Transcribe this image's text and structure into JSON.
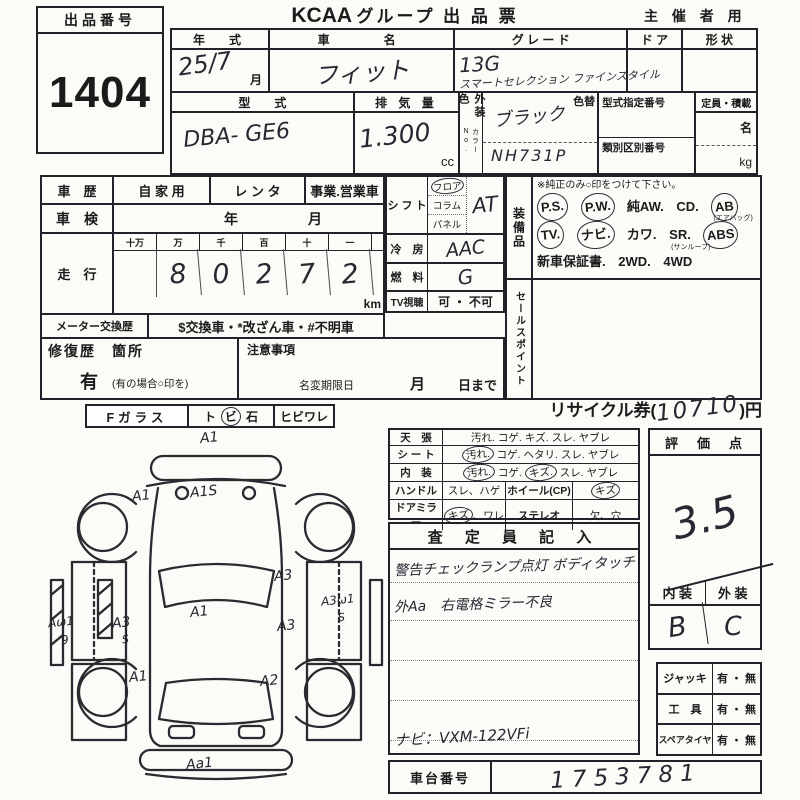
{
  "header": {
    "lot_label": "出品番号",
    "lot_number": "1404",
    "brand": "KCAA",
    "title": "グループ 出 品 票",
    "audience": "主 催 者 用"
  },
  "vehicle": {
    "year_label": "年　式",
    "year_value": "25/7",
    "year_month": "月",
    "name_label": "車　　名",
    "name_value": "フィット",
    "grade_label": "グ レ ー ド",
    "grade_line1": "13G",
    "grade_line2": "スマートセレクション ファインスタイル",
    "door_label": "ド ア",
    "shape_label": "形 状",
    "model_label": "型　　式",
    "model_value": "DBA- GE6",
    "disp_label": "排 気 量",
    "disp_value": "1.300",
    "disp_unit": "cc",
    "color_label": "外装色",
    "color_no_label": "カラーNo.",
    "color_change_label": "色替",
    "color_value": "ブラック",
    "color_code": "NH731P",
    "type_no_label": "型式指定番号",
    "class_no_label": "類別区別番号",
    "capacity_label": "定員・積載",
    "capacity_persons": "名",
    "capacity_weight": "kg"
  },
  "history": {
    "label": "車　歴",
    "opt_private": "自 家 用",
    "opt_rental": "レ ン タ",
    "opt_business": "事業.営業車",
    "inspection_label": "車　検",
    "inspection_year": "年",
    "inspection_month": "月"
  },
  "odometer": {
    "label": "走　行",
    "cols": [
      "十万",
      "万",
      "千",
      "百",
      "十",
      "一"
    ],
    "digits": [
      "",
      "8",
      "0",
      "2",
      "7",
      "2"
    ],
    "unit": "km",
    "meter_label": "メーター交換歴",
    "meter_text": "$交換車・*改ざん車・#不明車"
  },
  "shift": {
    "label": "シ フ ト",
    "opt_floor": "フロア",
    "opt_column": "コラム",
    "opt_panel": "パネル",
    "value": "AT",
    "circled": [
      "フロア"
    ],
    "ac_label": "冷　房",
    "ac_value": "AAC",
    "fuel_label": "燃　料",
    "fuel_value": "G",
    "tv_label": "TV視聴",
    "tv_value": "可 ・ 不可"
  },
  "equipment": {
    "side_label": "装備品",
    "note": "※純正のみ○印をつけて下さい。",
    "line1": {
      "i0": "P.S.",
      "i1": "P.W.",
      "i2": "純AW.",
      "i3": "CD.",
      "i4": "AB",
      "i4_sub": "(エアバッグ)"
    },
    "line2": {
      "i0": "TV.",
      "i1": "ナビ.",
      "i2": "カワ.",
      "i3": "SR.",
      "i3_sub": "(サンルーフ)",
      "i4": "ABS"
    },
    "line3": {
      "i0": "新車保証書.",
      "i1": "2WD.",
      "i2": "4WD"
    },
    "circled": [
      "P.S.",
      "P.W.",
      "AB",
      "TV.",
      "ナビ.",
      "ABS"
    ],
    "sales_label": "セールスポイント"
  },
  "repair": {
    "label": "修復歴　箇所",
    "notes_label": "注意事項",
    "yes": "有",
    "yes_note": "(有の場合○印を)",
    "rename_label": "名変期限日",
    "rename_month": "月",
    "rename_day": "日まで"
  },
  "glass": {
    "label": "Fガラス",
    "opt1": "ト",
    "opt2": "ビ",
    "opt3": "石",
    "crack": "ヒビワレ",
    "circled": [
      "ビ"
    ]
  },
  "recycle": {
    "prefix": "リサイクル券(",
    "value": "10710",
    "suffix": ")円"
  },
  "condition": {
    "r1": {
      "label": "天　張",
      "i0": "汚れ.",
      "i1": "コゲ.",
      "i2": "キズ.",
      "i3": "スレ.",
      "i4": "ヤブレ"
    },
    "r2": {
      "label": "シ ー ト",
      "i0": "汚れ.",
      "i1": "コゲ.",
      "i2": "ヘタリ.",
      "i3": "スレ.",
      "i4": "ヤブレ"
    },
    "r3": {
      "label": "内　装",
      "i0": "汚れ.",
      "i1": "コゲ.",
      "i2": "キズ.",
      "i3": "スレ.",
      "i4": "ヤブレ"
    },
    "r4": {
      "label": "ハンドル",
      "v1": "スレ、ハゲ",
      "label2": "ホイール(CP)",
      "v2": "キズ"
    },
    "r5": {
      "label": "ドアミラー",
      "v1a": "キズ",
      "v1b": "、ワレ",
      "label2": "ステレオ",
      "v2": "欠、穴"
    },
    "circled": [
      "シート:汚れ",
      "内装:汚れ",
      "内装:キズ",
      "ホイール(CP):キズ",
      "ドアミラー:キズ"
    ]
  },
  "inspector": {
    "header": "査 定 員 記 入",
    "note1": "警告チェックランプ点灯 ボディタッチ",
    "note2": "外Aa　右電格ミラー不良",
    "note3": "ナビ：VXM-122VFi"
  },
  "score": {
    "header": "評　価　点",
    "value": "3.5",
    "interior_label": "内 装",
    "exterior_label": "外 装",
    "interior_value": "B",
    "exterior_value": "C"
  },
  "accessories": {
    "r1": {
      "label": "ジャッキ",
      "value": "有 ・ 無"
    },
    "r2": {
      "label": "工　具",
      "value": "有 ・ 無"
    },
    "r3": {
      "label": "スペアタイヤ",
      "value": "有 ・ 無"
    }
  },
  "chassis": {
    "label": "車台番号",
    "value": "1753781"
  },
  "diagram": {
    "marks": [
      {
        "t": "A1"
      },
      {
        "t": "A1S"
      },
      {
        "t": "A1"
      },
      {
        "t": "A1"
      },
      {
        "t": "A3"
      },
      {
        "t": "S"
      },
      {
        "t": "Aω1"
      },
      {
        "t": "9"
      },
      {
        "t": "A3"
      },
      {
        "t": "A3"
      },
      {
        "t": "A3ω1"
      },
      {
        "t": "S"
      },
      {
        "t": "A2"
      },
      {
        "t": "A1"
      },
      {
        "t": "Aa1"
      }
    ]
  }
}
